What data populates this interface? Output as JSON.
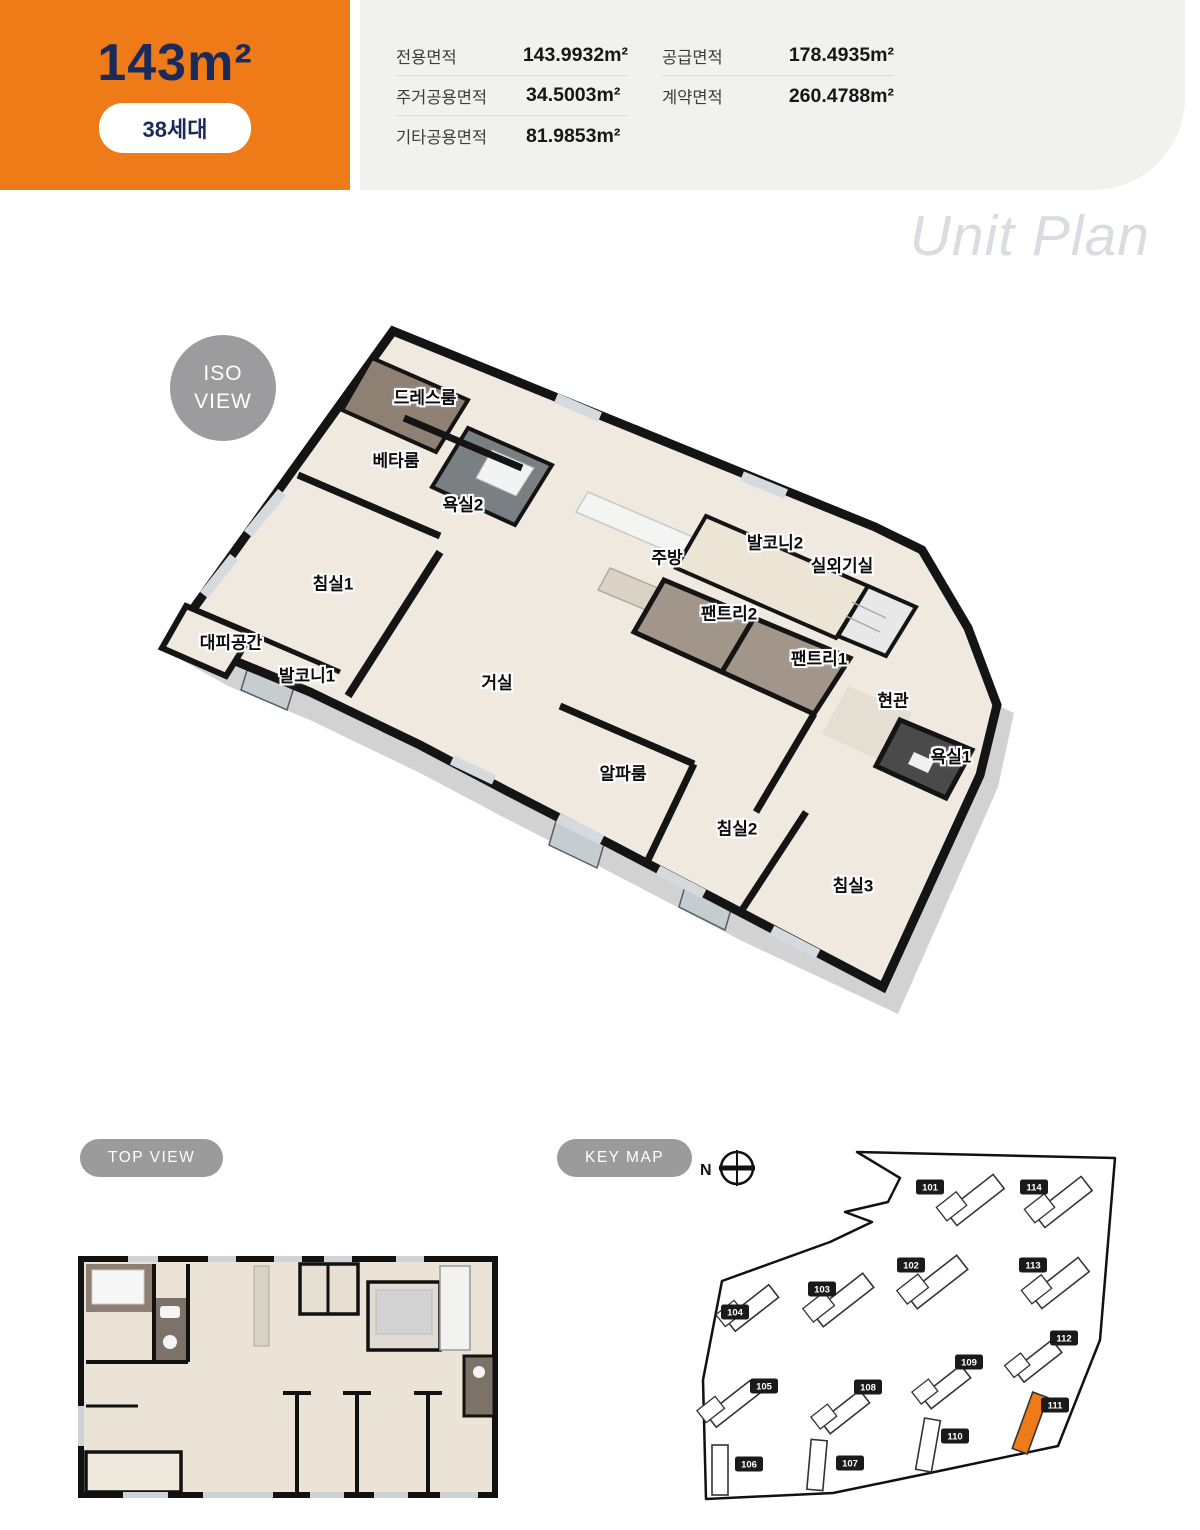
{
  "colors": {
    "accent": "#ee7b17",
    "navy": "#1b2a5b"
  },
  "header": {
    "size_label": "143m²",
    "badge": "38세대",
    "areas_left": [
      {
        "label": "전용면적",
        "value": "143.9932m²"
      },
      {
        "label": "주거공용면적",
        "value": "34.5003m²"
      },
      {
        "label": "기타공용면적",
        "value": "81.9853m²"
      }
    ],
    "areas_right": [
      {
        "label": "공급면적",
        "value": "178.4935m²"
      },
      {
        "label": "계약면적",
        "value": "260.4788m²"
      }
    ]
  },
  "watermark": "Unit Plan",
  "iso": {
    "badge_line1": "ISO",
    "badge_line2": "VIEW",
    "rooms": [
      {
        "label": "드레스룸",
        "x": 425,
        "y": 96
      },
      {
        "label": "베타룸",
        "x": 396,
        "y": 159
      },
      {
        "label": "욕실2",
        "x": 463,
        "y": 203
      },
      {
        "label": "주방",
        "x": 667,
        "y": 256
      },
      {
        "label": "발코니2",
        "x": 775,
        "y": 241
      },
      {
        "label": "실외기실",
        "x": 842,
        "y": 264
      },
      {
        "label": "팬트리2",
        "x": 729,
        "y": 312
      },
      {
        "label": "팬트리1",
        "x": 819,
        "y": 357
      },
      {
        "label": "현관",
        "x": 893,
        "y": 399
      },
      {
        "label": "욕실1",
        "x": 951,
        "y": 455
      },
      {
        "label": "침실1",
        "x": 333,
        "y": 282
      },
      {
        "label": "대피공간",
        "x": 231,
        "y": 341
      },
      {
        "label": "발코니1",
        "x": 307,
        "y": 374
      },
      {
        "label": "거실",
        "x": 497,
        "y": 381
      },
      {
        "label": "알파룸",
        "x": 623,
        "y": 472
      },
      {
        "label": "침실2",
        "x": 737,
        "y": 527
      },
      {
        "label": "침실3",
        "x": 853,
        "y": 584
      }
    ]
  },
  "top_view": {
    "badge": "TOP VIEW"
  },
  "key_map": {
    "badge": "KEY MAP",
    "north": "N",
    "highlight_id": "111",
    "buildings": [
      {
        "id": "101",
        "lx": 240,
        "ly": 42,
        "bx": 285,
        "by": 55,
        "rot": -38,
        "w": 60,
        "h": 18
      },
      {
        "id": "114",
        "lx": 344,
        "ly": 42,
        "bx": 373,
        "by": 57,
        "rot": -38,
        "w": 60,
        "h": 18
      },
      {
        "id": "102",
        "lx": 221,
        "ly": 120,
        "bx": 247,
        "by": 137,
        "rot": -38,
        "w": 64,
        "h": 18
      },
      {
        "id": "113",
        "lx": 343,
        "ly": 120,
        "bx": 370,
        "by": 138,
        "rot": -38,
        "w": 60,
        "h": 18
      },
      {
        "id": "103",
        "lx": 132,
        "ly": 144,
        "bx": 153,
        "by": 155,
        "rot": -38,
        "w": 64,
        "h": 18
      },
      {
        "id": "104",
        "lx": 45,
        "ly": 167,
        "bx": 62,
        "by": 163,
        "rot": -38,
        "w": 55,
        "h": 16
      },
      {
        "id": "105",
        "lx": 74,
        "ly": 241,
        "bx": 43,
        "by": 259,
        "rot": -38,
        "w": 55,
        "h": 16
      },
      {
        "id": "108",
        "lx": 178,
        "ly": 242,
        "bx": 155,
        "by": 267,
        "rot": -38,
        "w": 50,
        "h": 16
      },
      {
        "id": "109",
        "lx": 279,
        "ly": 217,
        "bx": 256,
        "by": 242,
        "rot": -38,
        "w": 50,
        "h": 16
      },
      {
        "id": "112",
        "lx": 374,
        "ly": 193,
        "bx": 348,
        "by": 216,
        "rot": -38,
        "w": 48,
        "h": 16
      },
      {
        "id": "111",
        "lx": 365,
        "ly": 260,
        "bx": 340,
        "by": 278,
        "rot": 20,
        "w": 16,
        "h": 60
      },
      {
        "id": "110",
        "lx": 265,
        "ly": 291,
        "bx": 238,
        "by": 300,
        "rot": 10,
        "w": 16,
        "h": 52
      },
      {
        "id": "106",
        "lx": 59,
        "ly": 319,
        "bx": 30,
        "by": 325,
        "rot": 0,
        "w": 16,
        "h": 50
      },
      {
        "id": "107",
        "lx": 160,
        "ly": 318,
        "bx": 127,
        "by": 320,
        "rot": 5,
        "w": 16,
        "h": 50
      }
    ]
  }
}
